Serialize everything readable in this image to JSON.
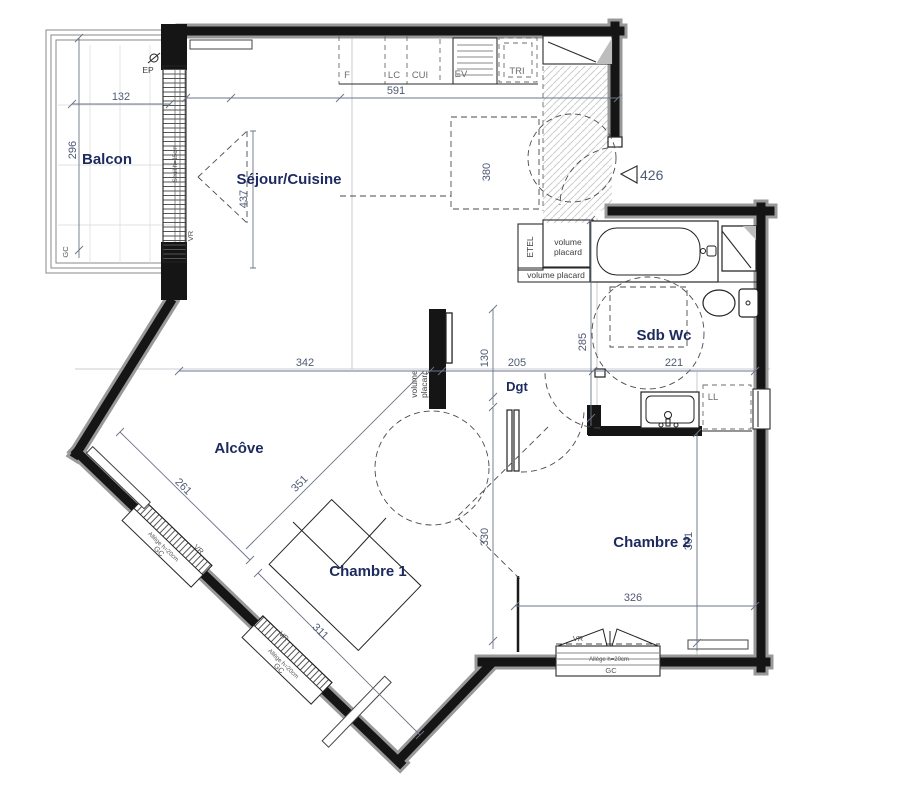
{
  "colors": {
    "label": "#1c2a5e",
    "dim": "#4e5a75",
    "annot": "#3c3c3c",
    "wall": "#151515",
    "wall_halo": "#999999",
    "hatch": "#cccccc"
  },
  "rooms": {
    "balcon": "Balcon",
    "sejour": "Séjour/Cuisine",
    "alcove": "Alcôve",
    "ch1": "Chambre 1",
    "ch2": "Chambre 2",
    "sdb": "Sdb Wc",
    "dgt": "Dgt"
  },
  "kitchen": {
    "f": "F",
    "lc": "LC",
    "cui": "CUI",
    "ev": "EV",
    "tri": "TRI"
  },
  "annot": {
    "ep": "EP",
    "vr": "VR",
    "gc": "GC",
    "seuil": "Seuil h=15cm",
    "allege": "Allège h=20cm",
    "etel": "ETEL",
    "vol": "volume",
    "plac": "placard",
    "vol_plac": "volume placard",
    "ll": "LL"
  },
  "entry_marker": "426",
  "dims": {
    "balcon_w": "132",
    "balcon_h": "296",
    "cuisine": "591",
    "porte_sejour": "437",
    "ilot": "380",
    "alcove_top": "342",
    "alcove_diag": "261",
    "alcove_ch1": "351",
    "ch1_diag": "311",
    "ch1_h": "330",
    "dgt_l": "205",
    "dgt_w": "130",
    "sdb_h": "285",
    "sdb_w": "221",
    "ch2_w": "326",
    "ch2_h": "301"
  }
}
